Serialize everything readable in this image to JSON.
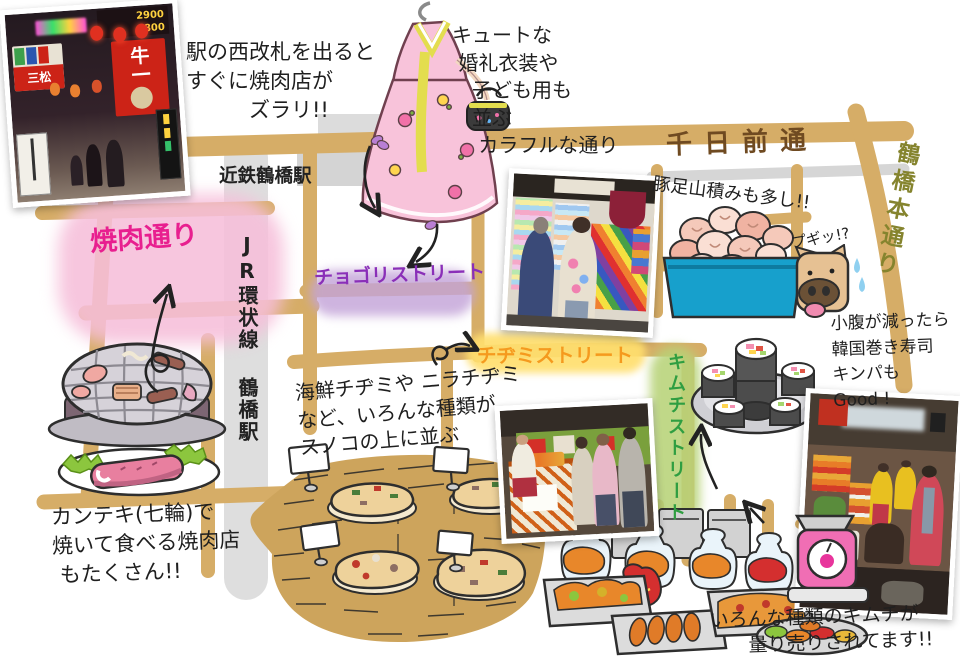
{
  "streets": {
    "sennichimae": "千日前通",
    "hondori": "鶴橋本通り",
    "jr_line": "JR環状線 鶴橋駅",
    "kintetsu": "近鉄鶴橋駅",
    "yakiniku": "焼肉通り",
    "chogori": "チョゴリストリート",
    "chijimi": "チヂミストリート",
    "kimchi": "キムチストリート"
  },
  "annotations": {
    "west_exit": "駅の西改札を出ると\nすぐに焼肉店が\n　　　ズラリ!!",
    "hanbok": "キュートな\n 婚礼衣装や\n　子ども用も\n　並ぶ\n　 カラフルな通り",
    "tonsoku": "豚足山積みも多し!!",
    "pig_cry": "プギッ!?",
    "chijimi_desc": "海鮮チヂミや ニラチヂミ\nなど、いろんな種類が\nスノコの上に並ぶ",
    "kimbap": "小腹が減ったら\n韓国巻き寿司\nキンパも\nGood !",
    "kanteki": "カンテキ(七輪)で\n焼いて食べる焼肉店\n もたくさん!!",
    "kimchi_sale": "いろんな種類のキムチが\n　　量り売りされてます!!"
  },
  "photo_signs": {
    "beef_sign": "牛一",
    "price_top": "2900",
    "price_bottom": "6800",
    "mimatsu": "三松"
  },
  "colors": {
    "road_tan": "#d6ad67",
    "rail_gray": "#dedede",
    "yakiniku_highlight": "#f5bfd9",
    "yakiniku_text": "#e81f8f",
    "chogori_highlight": "#c3a4d8",
    "chogori_text": "#8a2fb8",
    "chijimi_highlight": "#ffde6e",
    "chijimi_text": "#f59a1e",
    "kimchi_highlight": "#b7d378",
    "kimchi_text": "#2f9e41",
    "sennichimae_text": "#6f4a21",
    "hondori_text": "#85842e",
    "ink": "#1f1f1f"
  }
}
